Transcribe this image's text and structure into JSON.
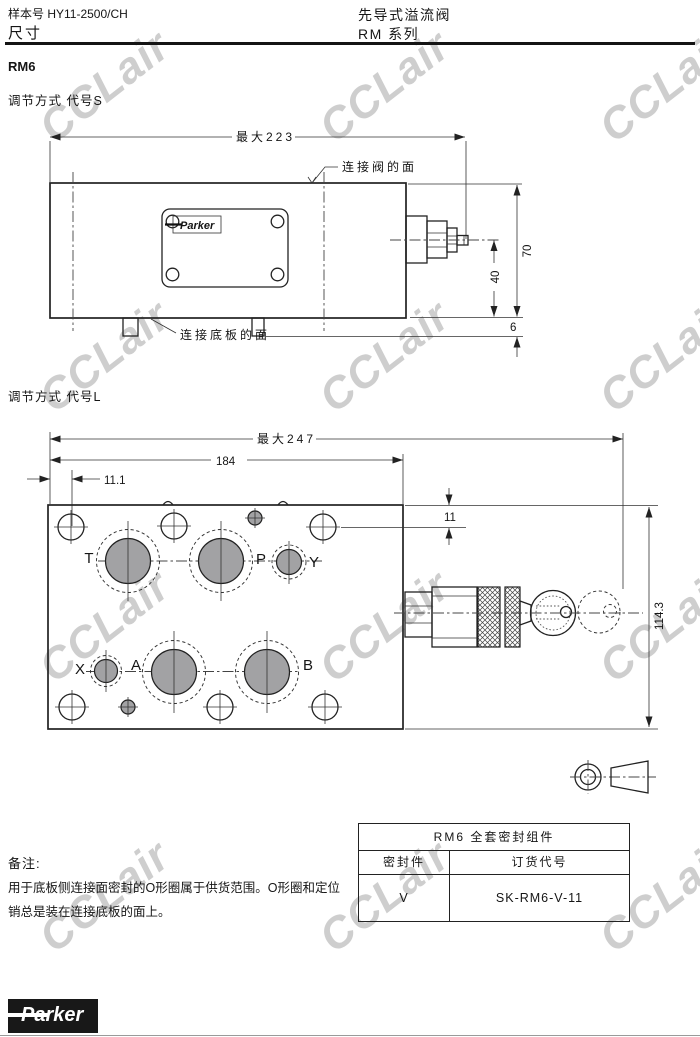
{
  "header": {
    "sample_no": "样本号 HY11-2500/CH",
    "page_title": "尺寸",
    "product_title": "先导式溢流阀",
    "series": "RM  系列"
  },
  "model": "RM6",
  "sections": {
    "s_heading": "调节方式 代号S",
    "l_heading": "调节方式 代号L"
  },
  "drawing1": {
    "max_width": "最大223",
    "height": "70",
    "center_height": "40",
    "pin_offset": "6",
    "valve_face_label": "连接阀的面",
    "subplate_face_label": "连接底板的面",
    "nameplate_brand": "Parker"
  },
  "drawing2": {
    "max_width": "最大247",
    "width": "184",
    "offset": "11.1",
    "top_offset": "11",
    "height": "114.3",
    "ports": {
      "t": "T",
      "p": "P",
      "y": "Y",
      "x": "X",
      "a": "A",
      "b": "B"
    }
  },
  "notes": {
    "title": "备注:",
    "line1": "用于底板侧连接面密封的O形圈属于供货范围。O形圈和定位",
    "line2": "销总是装在连接底板的面上。"
  },
  "seal_table": {
    "title": "RM6  全套密封组件",
    "col_seal": "密封件",
    "col_code": "订货代号",
    "seal_value": "V",
    "code_value": "SK-RM6-V-11"
  },
  "footer": {
    "brand": "Parker"
  },
  "watermark": {
    "text": "CCLair"
  },
  "colors": {
    "line": "#222222",
    "port_fill": "#a2a2a4",
    "watermark": "#a5a5a5",
    "logo_bg": "#181818"
  }
}
